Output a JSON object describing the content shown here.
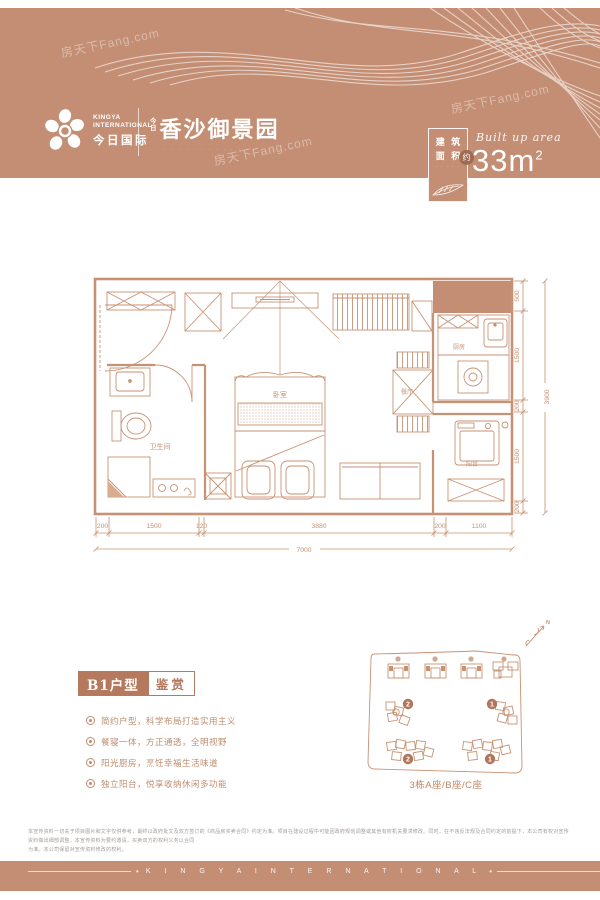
{
  "colors": {
    "band": "#c38e73",
    "plan_line": "#c79273",
    "accent_fill": "#b5795e",
    "badge_circle": "#9e6c52",
    "bullet_text": "#bf8d6f"
  },
  "watermark": {
    "text": "房天下Fang.com"
  },
  "header": {
    "brand": {
      "line1": "KINGYA",
      "line2": "INTERNATIONAL",
      "cn": "今日国际"
    },
    "project": {
      "prefix_top": "今",
      "prefix_bottom": "日",
      "title": "香沙御景园",
      "subtitle_dots": "· · · · · · · · · · · · · ·"
    },
    "area_badge": {
      "chars": [
        "建",
        "筑",
        "面",
        "积"
      ],
      "approx": "约",
      "dots": "· · · · ·",
      "script": "Built up area",
      "value": "33m",
      "sup": "2"
    }
  },
  "floorplan": {
    "rooms": [
      "卫生间",
      "卧室",
      "餐厅",
      "厨房",
      "阳台"
    ],
    "dims_bottom": [
      "200",
      "1500",
      "120",
      "3880",
      "200",
      "1100"
    ],
    "dims_bottom_total": "7000",
    "dims_right": [
      "500",
      "1500",
      "200",
      "1500",
      "200"
    ],
    "dims_right_total": "3900"
  },
  "details": {
    "type_label": "B1户型",
    "type_suffix": "鉴赏",
    "bullets": [
      "简约户型，科学布局打造实用主义",
      "餐寝一体，方正通透，全明视野",
      "阳光厨房，烹饪幸福生活味道",
      "独立阳台，悦享收纳休闲多功能"
    ]
  },
  "siteplan": {
    "north": "N",
    "badges": [
      "2",
      "1",
      "2",
      "1"
    ],
    "caption": "3栋A座/B座/C座"
  },
  "disclaimer": {
    "line1": "本宣传资料一切关于项目图片和文字仅供参考，最终以政府批文及双方签订的《商品房买卖合同》约定为准。项目在建设过程中可能因政府规划调整或其他有权机关要求修改。同时，在不违反法规及合同约定的前提下，本公司有权对宣传资料做出细部调整。本宣传资料为要约邀请，买卖双方的权利义务以合同",
    "line2": "为准。本公司保留对宣传资料修改的权利。"
  },
  "footer": {
    "brand": "K I N G Y A   I N T E R N A T I O N A L"
  }
}
